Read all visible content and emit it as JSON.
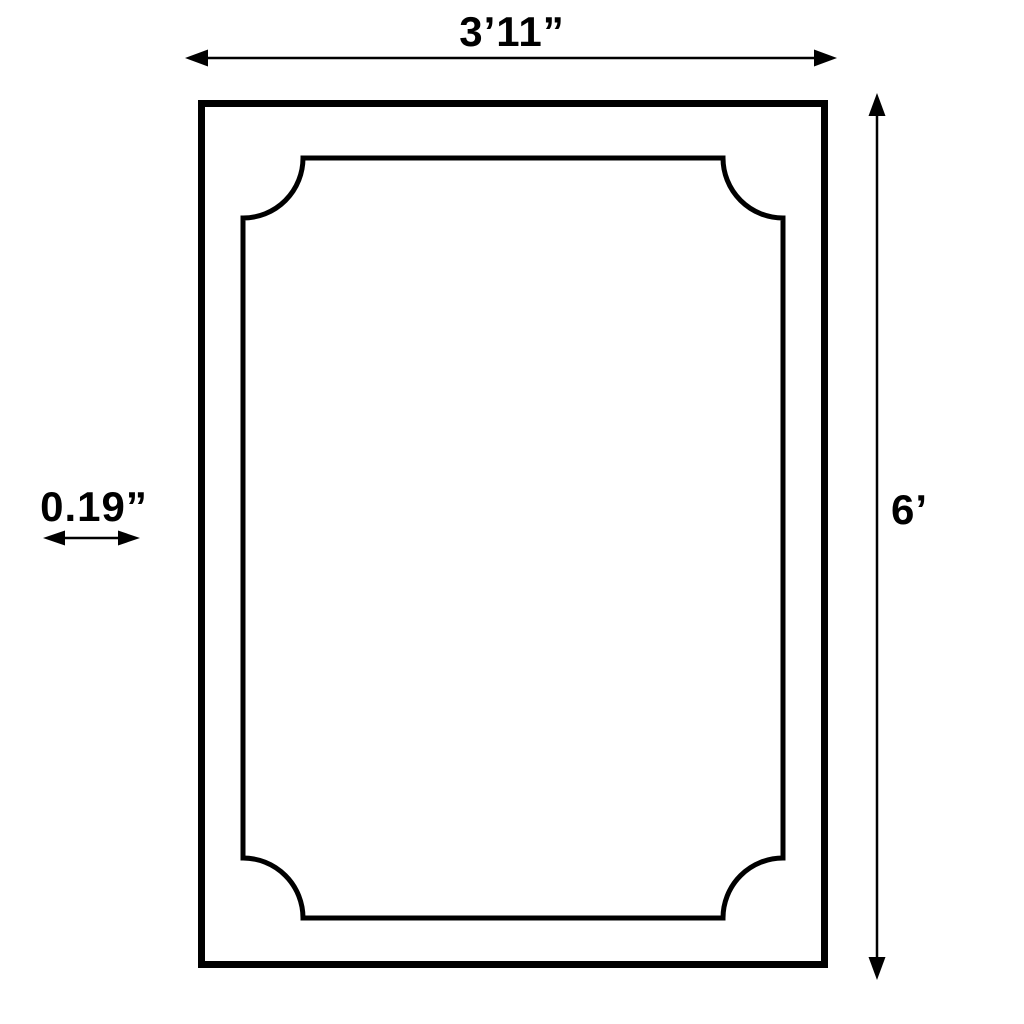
{
  "diagram": {
    "type": "dimension-drawing",
    "labels": {
      "width": "3’11”",
      "height": "6’",
      "thickness": "0.19”"
    },
    "colors": {
      "line": "#000000",
      "background": "#ffffff"
    }
  }
}
